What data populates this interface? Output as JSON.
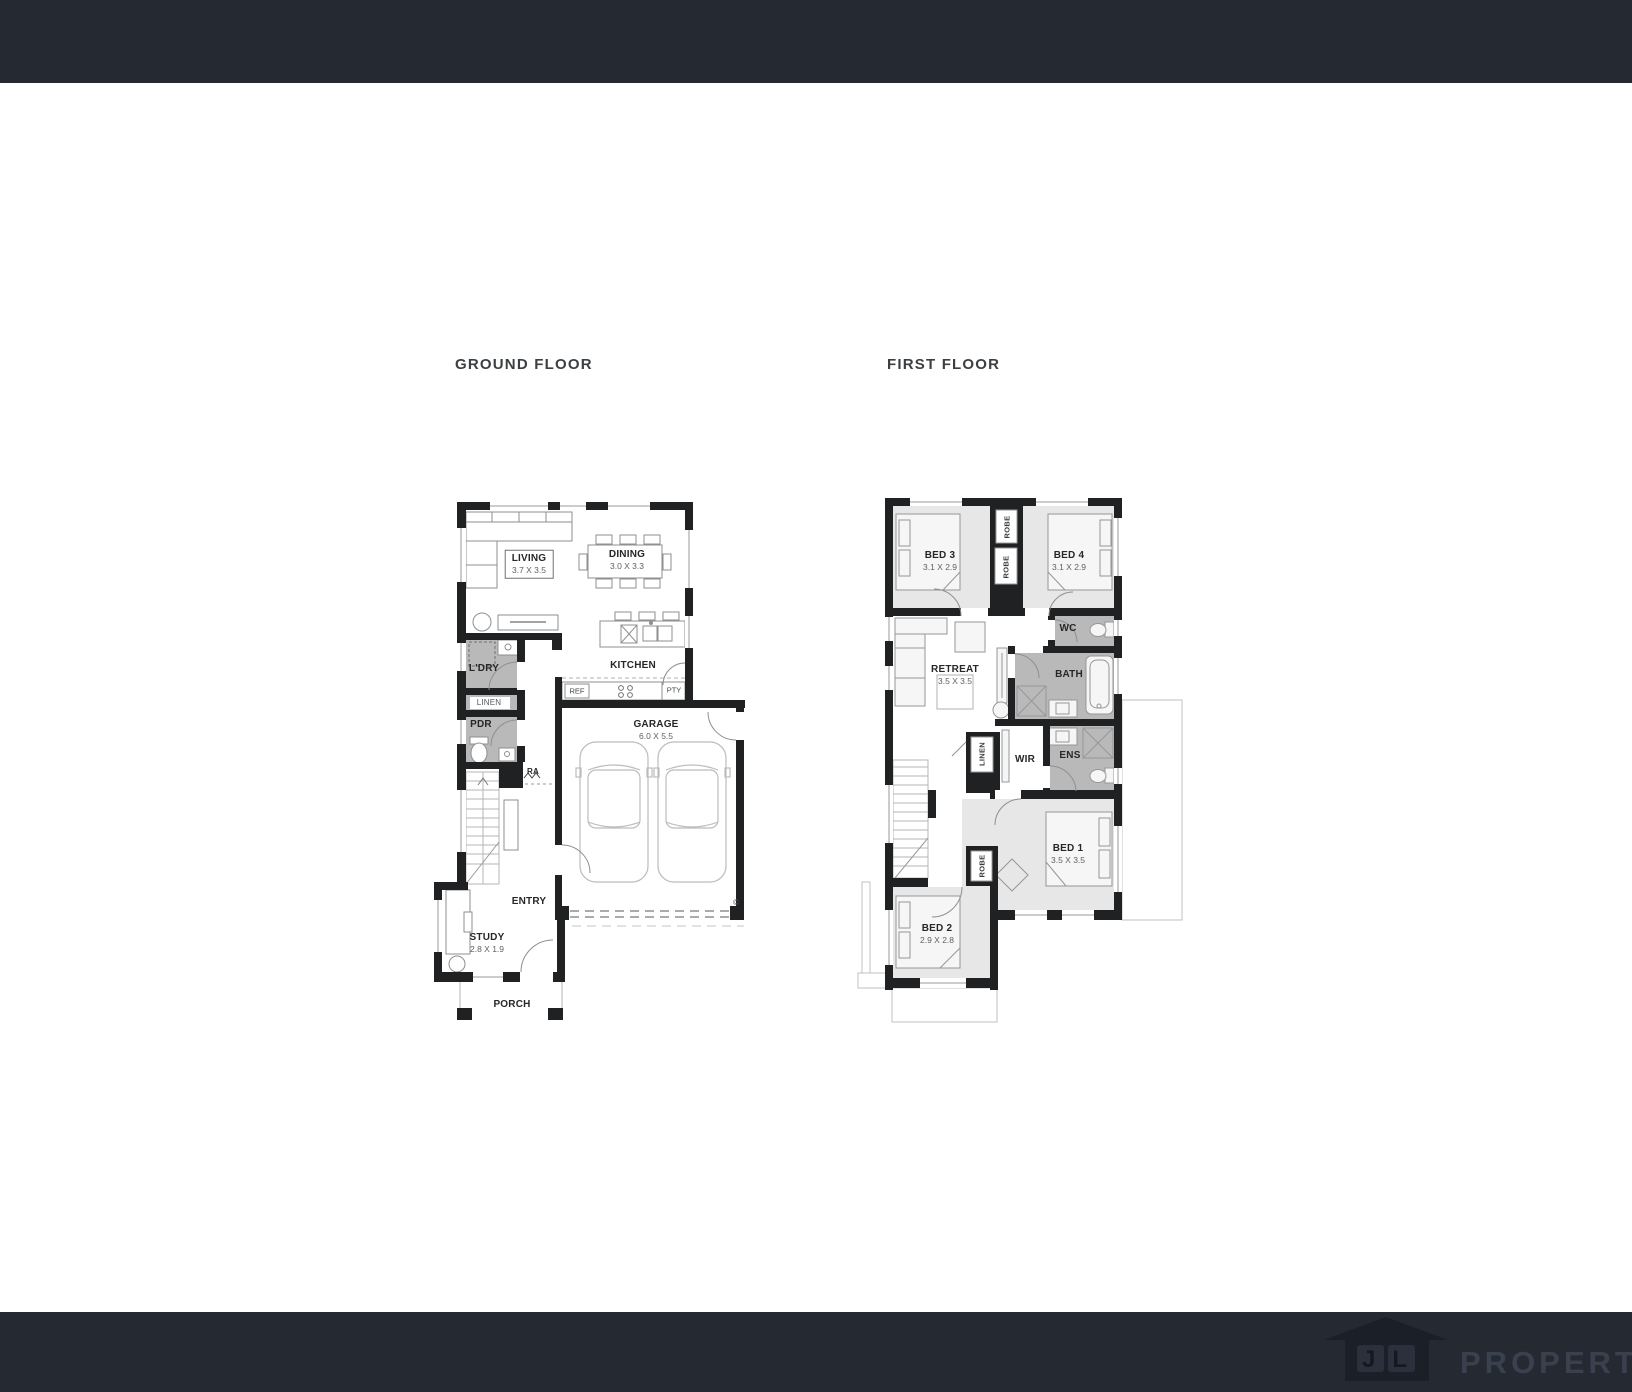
{
  "titles": {
    "ground": "GROUND FLOOR",
    "first": "FIRST FLOOR"
  },
  "ground": {
    "living": {
      "name": "LIVING",
      "dims": "3.7 X 3.5"
    },
    "dining": {
      "name": "DINING",
      "dims": "3.0 X 3.3"
    },
    "kitchen": {
      "name": "KITCHEN"
    },
    "ref": {
      "name": "REF"
    },
    "pty": {
      "name": "PTY"
    },
    "ldry": {
      "name": "L'DRY"
    },
    "linen": {
      "name": "LINEN"
    },
    "pdr": {
      "name": "PDR"
    },
    "ra": {
      "name": "RA"
    },
    "garage": {
      "name": "GARAGE",
      "dims": "6.0 X 5.5"
    },
    "entry": {
      "name": "ENTRY"
    },
    "study": {
      "name": "STUDY",
      "dims": "2.8 X 1.9"
    },
    "porch": {
      "name": "PORCH"
    },
    "copyright": "©"
  },
  "first": {
    "bed3": {
      "name": "BED 3",
      "dims": "3.1 X 2.9"
    },
    "bed4": {
      "name": "BED 4",
      "dims": "3.1 X 2.9"
    },
    "robe1": {
      "name": "ROBE"
    },
    "robe2": {
      "name": "ROBE"
    },
    "robe3": {
      "name": "ROBE"
    },
    "wc": {
      "name": "WC"
    },
    "retreat": {
      "name": "RETREAT",
      "dims": "3.5 X 3.5"
    },
    "bath": {
      "name": "BATH"
    },
    "linen": {
      "name": "LINEN"
    },
    "wir": {
      "name": "WIR"
    },
    "ens": {
      "name": "ENS"
    },
    "bed1": {
      "name": "BED 1",
      "dims": "3.5 X 3.5"
    },
    "bed2": {
      "name": "BED 2",
      "dims": "2.9 X 2.8"
    }
  },
  "footer": {
    "logo_initials": "JL",
    "logo_name": "PROPERTY"
  },
  "colors": {
    "bar": "#242932",
    "wall": "#1f2122",
    "room_light": "#e7e7e7",
    "room_wet": "#b9b9b9",
    "logo_house": "#1b2028",
    "logo_text": "#3a414e"
  }
}
